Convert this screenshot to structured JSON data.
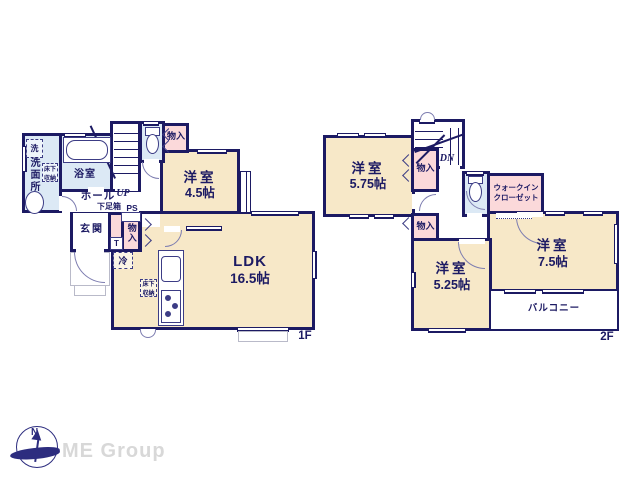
{
  "colors": {
    "wall": "#1c1a63",
    "room_cream": "#f7e8c8",
    "wet_blue": "#dce9f5",
    "storage_pink": "#fbd9da",
    "logo_gray": "#d8d8d8"
  },
  "floor1": {
    "floor_label": "1F",
    "washroom": {
      "name": "洗面所",
      "washer": "洗",
      "underfloor": "床下収納"
    },
    "bath": {
      "name": "浴室"
    },
    "hall": {
      "name": "ホール"
    },
    "stairs_label": "UP",
    "shoe_cabinet": "下足箱",
    "pipe_space": "PS",
    "entrance": {
      "name": "玄関"
    },
    "tile_label": "T",
    "storage_upper": "物入",
    "storage_side": "物入",
    "fridge": "冷",
    "underfloor": "床下収納",
    "western_room": {
      "name": "洋室",
      "size": "4.5帖"
    },
    "ldk": {
      "name": "LDK",
      "size": "16.5帖"
    }
  },
  "floor2": {
    "floor_label": "2F",
    "stairs_label": "DN",
    "western_room_a": {
      "name": "洋室",
      "size": "5.75帖"
    },
    "western_room_b": {
      "name": "洋室",
      "size": "5.25帖"
    },
    "western_room_c": {
      "name": "洋室",
      "size": "7.5帖"
    },
    "storage_upper": "物入",
    "storage_lower": "物入",
    "walk_in_closet": {
      "line1": "ウォークイン",
      "line2": "クローゼット"
    },
    "balcony": {
      "name": "バルコニー"
    }
  },
  "footer": {
    "compass_north": "N",
    "logo": "ME Group"
  }
}
